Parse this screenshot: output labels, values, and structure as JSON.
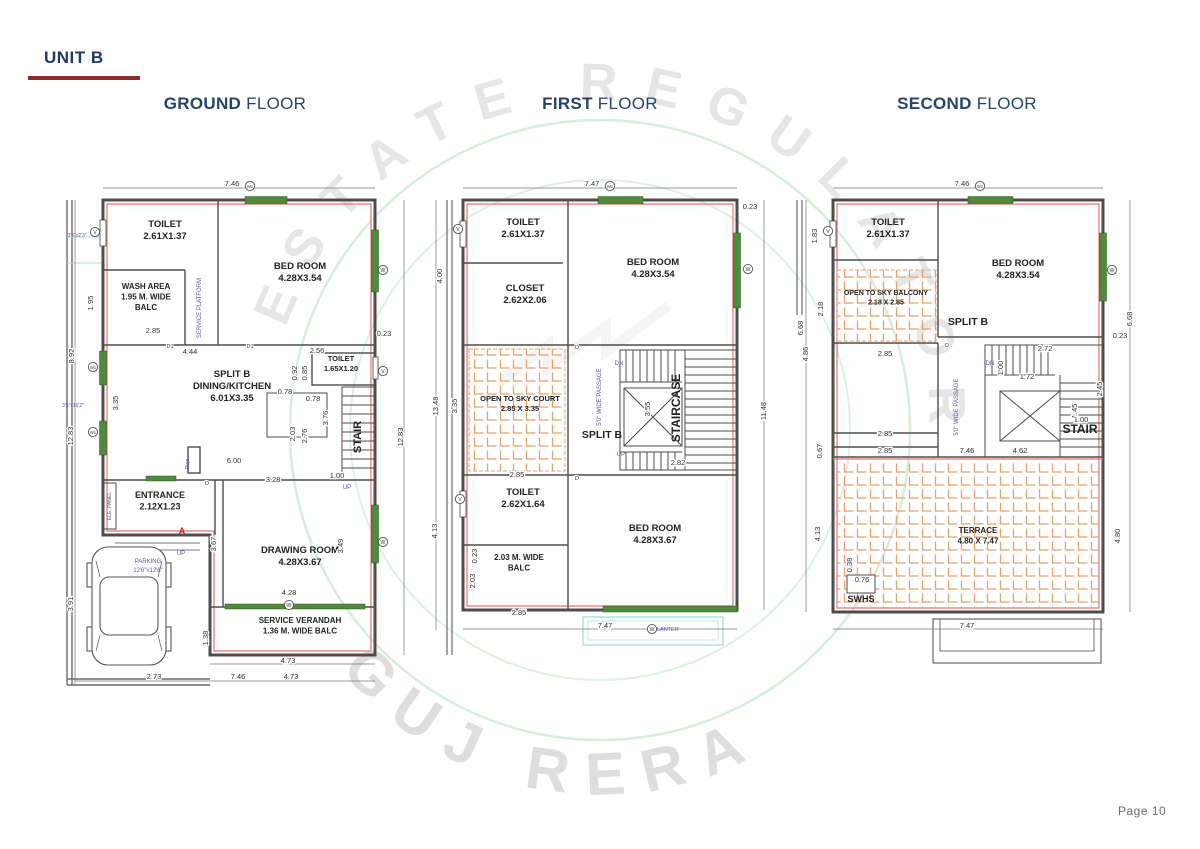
{
  "page": {
    "unit_label": "UNIT B",
    "page_number": "Page 10"
  },
  "watermark": {
    "arc_text": "ESTATE REGULATOR",
    "brand_text": "GUJ RERA"
  },
  "colors": {
    "title_navy": "#24466b",
    "accent_red": "#93282e",
    "plan_red_line": "#e57373",
    "window_green": "#4f8a3d",
    "hatch_orange": "#e4a26e",
    "note_purple": "#5b54a8",
    "teal_line": "#8fd0c6"
  },
  "floors": [
    {
      "id": "ground",
      "title_bold": "GROUND",
      "title_rest": "FLOOR",
      "rooms": [
        {
          "x": 105,
          "y": 52,
          "lines": [
            "TOILET",
            "2.61X1.37"
          ]
        },
        {
          "x": 240,
          "y": 94,
          "lines": [
            "BED ROOM",
            "4.28X3.54"
          ]
        },
        {
          "x": 86,
          "y": 114,
          "lines": [
            "WASH AREA",
            "1.95 M. WIDE",
            "BALC"
          ],
          "size": 8
        },
        {
          "x": 172,
          "y": 202,
          "lines": [
            "SPLIT B",
            "DINING/KITCHEN",
            "6.01X3.35"
          ]
        },
        {
          "x": 281,
          "y": 186,
          "lines": [
            "TOILET",
            "1.65X1.20"
          ],
          "size": 7.5
        },
        {
          "x": 100,
          "y": 323,
          "lines": [
            "ENTRANCE",
            "2.12X1.23"
          ],
          "size": 9
        },
        {
          "x": 240,
          "y": 378,
          "lines": [
            "DRAWING ROOM",
            "4.28X3.67"
          ]
        },
        {
          "x": 240,
          "y": 448,
          "lines": [
            "SERVICE VERANDAH",
            "1.36 M. WIDE BALC"
          ],
          "size": 8
        },
        {
          "x": 301,
          "y": 262,
          "lines": [
            "STAIR"
          ],
          "size": 11,
          "v": 1
        }
      ],
      "dims": [
        {
          "t": "7.46",
          "x": 172,
          "y": 11
        },
        {
          "t": "2.85",
          "x": 93,
          "y": 158
        },
        {
          "t": "4.44",
          "x": 130,
          "y": 179
        },
        {
          "t": "2.56",
          "x": 257,
          "y": 178
        },
        {
          "t": "0.92",
          "x": 237,
          "y": 198,
          "v": 1
        },
        {
          "t": "0.85",
          "x": 247,
          "y": 198,
          "v": 1
        },
        {
          "t": "0.78",
          "x": 225,
          "y": 219
        },
        {
          "t": "0.78",
          "x": 253,
          "y": 226
        },
        {
          "t": "2.03",
          "x": 235,
          "y": 259,
          "v": 1
        },
        {
          "t": "2.76",
          "x": 247,
          "y": 261,
          "v": 1
        },
        {
          "t": "3.76",
          "x": 268,
          "y": 243,
          "v": 1
        },
        {
          "t": "6.00",
          "x": 174,
          "y": 288
        },
        {
          "t": "3.28",
          "x": 213,
          "y": 307
        },
        {
          "t": "1.00",
          "x": 277,
          "y": 303
        },
        {
          "t": "1.95",
          "x": 33,
          "y": 128,
          "v": 1
        },
        {
          "t": "3.35",
          "x": 58,
          "y": 228,
          "v": 1
        },
        {
          "t": "8.92",
          "x": 14,
          "y": 181,
          "v": 1
        },
        {
          "t": "12.83",
          "x": 13,
          "y": 261,
          "v": 1
        },
        {
          "t": "3.91",
          "x": 13,
          "y": 429,
          "v": 1
        },
        {
          "t": "3.67",
          "x": 156,
          "y": 369,
          "v": 1
        },
        {
          "t": "3.49",
          "x": 283,
          "y": 371,
          "v": 1
        },
        {
          "t": "4.28",
          "x": 229,
          "y": 420
        },
        {
          "t": "1.38",
          "x": 148,
          "y": 463,
          "v": 1
        },
        {
          "t": "4.73",
          "x": 228,
          "y": 488
        },
        {
          "t": "2.73",
          "x": 94,
          "y": 504
        },
        {
          "t": "7.46",
          "x": 178,
          "y": 504
        },
        {
          "t": "4.73",
          "x": 231,
          "y": 504
        },
        {
          "t": "0.23",
          "x": 324,
          "y": 161
        },
        {
          "t": "12.83",
          "x": 343,
          "y": 262,
          "v": 1
        }
      ],
      "notes": [
        {
          "t": "SERVICE PLATFORM",
          "x": 141,
          "y": 133,
          "v": 1
        },
        {
          "t": "3'5\"x2'3\"",
          "x": 17,
          "y": 62,
          "size": 5
        },
        {
          "t": "3'5\"x16'2\"",
          "x": 13,
          "y": 232,
          "size": 5
        },
        {
          "t": "PARKING",
          "x": 88,
          "y": 388
        },
        {
          "t": "12'6\"x12'6\"",
          "x": 88,
          "y": 397
        },
        {
          "t": "Puja",
          "x": 129,
          "y": 289,
          "v": 1,
          "size": 5.5
        },
        {
          "t": "UP",
          "x": 121,
          "y": 380
        },
        {
          "t": "UP",
          "x": 287,
          "y": 314
        },
        {
          "t": "ELE. PANEL",
          "x": 51,
          "y": 331,
          "v": 1,
          "size": 5
        },
        {
          "t": "A",
          "x": 122,
          "y": 359,
          "size": 9,
          "c": "#cc2222"
        }
      ],
      "marks": [
        {
          "t": "V",
          "x": 35,
          "y": 57
        },
        {
          "t": "W1",
          "x": 33,
          "y": 192
        },
        {
          "t": "W1",
          "x": 33,
          "y": 257
        },
        {
          "t": "W",
          "x": 323,
          "y": 95
        },
        {
          "t": "V",
          "x": 323,
          "y": 196
        },
        {
          "t": "W",
          "x": 323,
          "y": 367
        },
        {
          "t": "W",
          "x": 229,
          "y": 430
        },
        {
          "t": "W1",
          "x": 190,
          "y": 11
        }
      ],
      "doors": [
        {
          "t": "D1",
          "x": 110,
          "y": 173
        },
        {
          "t": "D1",
          "x": 190,
          "y": 173
        },
        {
          "t": "D",
          "x": 147,
          "y": 310
        }
      ],
      "dlines": [
        [
          43,
          13,
          315,
          13
        ],
        [
          15,
          25,
          15,
          510
        ],
        [
          344,
          25,
          344,
          480
        ],
        [
          15,
          506,
          315,
          506
        ],
        [
          150,
          489,
          315,
          489
        ]
      ]
    },
    {
      "id": "first",
      "title_bold": "FIRST",
      "title_rest": "FLOOR",
      "rooms": [
        {
          "x": 103,
          "y": 50,
          "lines": [
            "TOILET",
            "2.61X1.37"
          ]
        },
        {
          "x": 105,
          "y": 116,
          "lines": [
            "CLOSET",
            "2.62X2.06"
          ]
        },
        {
          "x": 233,
          "y": 90,
          "lines": [
            "BED ROOM",
            "4.28X3.54"
          ]
        },
        {
          "x": 100,
          "y": 226,
          "lines": [
            "OPEN TO SKY COURT",
            "2.85 X 3.35"
          ],
          "size": 7.5
        },
        {
          "x": 182,
          "y": 263,
          "lines": [
            "SPLIT B"
          ],
          "size": 10.5
        },
        {
          "x": 260,
          "y": 233,
          "lines": [
            "STAIRCASE"
          ],
          "size": 12,
          "v": 1
        },
        {
          "x": 103,
          "y": 320,
          "lines": [
            "TOILET",
            "2.62X1.64"
          ]
        },
        {
          "x": 99,
          "y": 385,
          "lines": [
            "2.03 M. WIDE",
            "BALC"
          ],
          "size": 8
        },
        {
          "x": 235,
          "y": 356,
          "lines": [
            "BED ROOM",
            "4.28X3.67"
          ]
        }
      ],
      "dims": [
        {
          "t": "7.47",
          "x": 172,
          "y": 11
        },
        {
          "t": "0.23",
          "x": 330,
          "y": 34
        },
        {
          "t": "4.00",
          "x": 22,
          "y": 101,
          "v": 1
        },
        {
          "t": "13.48",
          "x": 18,
          "y": 231,
          "v": 1
        },
        {
          "t": "3.35",
          "x": 37,
          "y": 231,
          "v": 1
        },
        {
          "t": "3.55",
          "x": 230,
          "y": 234,
          "v": 1
        },
        {
          "t": "2.82",
          "x": 258,
          "y": 290
        },
        {
          "t": "2.85",
          "x": 97,
          "y": 302
        },
        {
          "t": "11.48",
          "x": 346,
          "y": 236,
          "v": 1
        },
        {
          "t": "4.13",
          "x": 17,
          "y": 356,
          "v": 1
        },
        {
          "t": "0.23",
          "x": 57,
          "y": 381,
          "v": 1
        },
        {
          "t": "2.03",
          "x": 55,
          "y": 406,
          "v": 1
        },
        {
          "t": "2.85",
          "x": 99,
          "y": 440
        },
        {
          "t": "7.47",
          "x": 185,
          "y": 453
        }
      ],
      "notes": [
        {
          "t": "DN",
          "x": 199,
          "y": 190
        },
        {
          "t": "UP",
          "x": 201,
          "y": 281
        },
        {
          "t": "5'0\" WIDE PASSAGE",
          "x": 181,
          "y": 222,
          "v": 1
        },
        {
          "t": "PLANTER",
          "x": 246,
          "y": 456,
          "size": 5.5
        }
      ],
      "marks": [
        {
          "t": "V",
          "x": 38,
          "y": 54
        },
        {
          "t": "V",
          "x": 40,
          "y": 324
        },
        {
          "t": "W",
          "x": 328,
          "y": 94
        },
        {
          "t": "W",
          "x": 232,
          "y": 454
        },
        {
          "t": "W1",
          "x": 190,
          "y": 11
        }
      ],
      "doors": [
        {
          "t": "D",
          "x": 157,
          "y": 174
        },
        {
          "t": "D",
          "x": 157,
          "y": 305
        }
      ],
      "dlines": [
        [
          43,
          13,
          317,
          13
        ],
        [
          16,
          25,
          16,
          455
        ],
        [
          344,
          25,
          344,
          435
        ],
        [
          43,
          454,
          317,
          454
        ]
      ]
    },
    {
      "id": "second",
      "title_bold": "SECOND",
      "title_rest": "FLOOR",
      "rooms": [
        {
          "x": 98,
          "y": 50,
          "lines": [
            "TOILET",
            "2.61X1.37"
          ]
        },
        {
          "x": 228,
          "y": 91,
          "lines": [
            "BED ROOM",
            "4.28X3.54"
          ]
        },
        {
          "x": 96,
          "y": 120,
          "lines": [
            "OPEN TO SKY BALCONY",
            "2.18 X 2.85"
          ],
          "size": 7
        },
        {
          "x": 178,
          "y": 150,
          "lines": [
            "SPLIT B"
          ],
          "size": 10.5
        },
        {
          "x": 290,
          "y": 258,
          "lines": [
            "STAIR"
          ],
          "size": 12
        },
        {
          "x": 188,
          "y": 358,
          "lines": [
            "TERRACE",
            "4.80 X 7.47"
          ],
          "size": 8
        },
        {
          "x": 71,
          "y": 427,
          "lines": [
            "SWHS"
          ],
          "size": 9
        }
      ],
      "dims": [
        {
          "t": "7.46",
          "x": 172,
          "y": 11
        },
        {
          "t": "1.83",
          "x": 27,
          "y": 61,
          "v": 1
        },
        {
          "t": "2.18",
          "x": 33,
          "y": 134,
          "v": 1
        },
        {
          "t": "6.68",
          "x": 13,
          "y": 153,
          "v": 1
        },
        {
          "t": "2.85",
          "x": 95,
          "y": 181
        },
        {
          "t": "4.86",
          "x": 18,
          "y": 179,
          "v": 1
        },
        {
          "t": "2.85",
          "x": 95,
          "y": 261
        },
        {
          "t": "2.85",
          "x": 95,
          "y": 278
        },
        {
          "t": "0.67",
          "x": 32,
          "y": 276,
          "v": 1
        },
        {
          "t": "2.72",
          "x": 255,
          "y": 176
        },
        {
          "t": "1.00",
          "x": 213,
          "y": 193,
          "v": 1
        },
        {
          "t": "1.72",
          "x": 237,
          "y": 204
        },
        {
          "t": "2.45",
          "x": 312,
          "y": 214,
          "v": 1
        },
        {
          "t": "1.45",
          "x": 287,
          "y": 236,
          "v": 1
        },
        {
          "t": "1.00",
          "x": 291,
          "y": 247
        },
        {
          "t": "7.46",
          "x": 177,
          "y": 278
        },
        {
          "t": "4.62",
          "x": 230,
          "y": 278
        },
        {
          "t": "6.68",
          "x": 342,
          "y": 144,
          "v": 1
        },
        {
          "t": "0.23",
          "x": 330,
          "y": 163
        },
        {
          "t": "4.80",
          "x": 330,
          "y": 361,
          "v": 1
        },
        {
          "t": "4.13",
          "x": 30,
          "y": 359,
          "v": 1
        },
        {
          "t": "0.38",
          "x": 62,
          "y": 390,
          "v": 1
        },
        {
          "t": "0.76",
          "x": 72,
          "y": 407
        },
        {
          "t": "7.47",
          "x": 177,
          "y": 453
        }
      ],
      "notes": [
        {
          "t": "DN",
          "x": 200,
          "y": 190
        },
        {
          "t": "5'0\" WIDE PASSAGE",
          "x": 168,
          "y": 232,
          "v": 1
        }
      ],
      "marks": [
        {
          "t": "V",
          "x": 38,
          "y": 56
        },
        {
          "t": "W",
          "x": 322,
          "y": 95
        },
        {
          "t": "W1",
          "x": 190,
          "y": 11
        }
      ],
      "doors": [
        {
          "t": "D",
          "x": 157,
          "y": 172
        }
      ],
      "dlines": [
        [
          43,
          13,
          313,
          13
        ],
        [
          16,
          25,
          16,
          437
        ],
        [
          340,
          25,
          340,
          437
        ],
        [
          43,
          454,
          313,
          454
        ]
      ]
    }
  ]
}
